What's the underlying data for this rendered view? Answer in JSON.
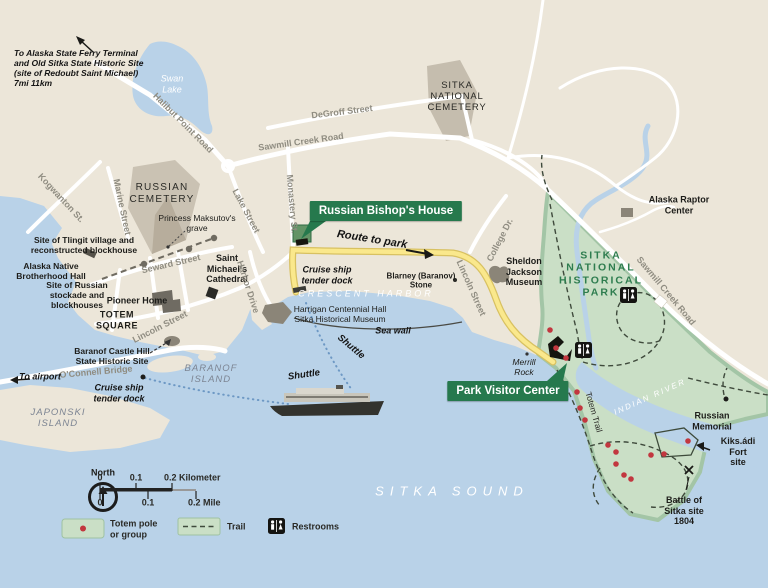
{
  "colors": {
    "water": "#b9d2e8",
    "land": "#ece6d9",
    "park": "#cadfc6",
    "park_border": "#a3c5a6",
    "road": "#ffffff",
    "road_label": "#8f8c81",
    "route_yellow": "#fae88c",
    "route_casing": "#d8c161",
    "badge_green": "#26794d",
    "park_label_green": "#2e7d4f",
    "totem_red": "#c2373f",
    "shuttle_blue": "#6d98c4",
    "building_gray": "#8b8578",
    "cemetery_gray": "#c8c0b1"
  },
  "labels": {
    "ferry_note": "To Alaska State Ferry Terminal\nand Old Sitka State Historic Site\n(site of Redoubt Saint Michael)\n7mi 11km",
    "swan_lake": "Swan\nLake",
    "halibut_point_road": "Halibut Point Road",
    "degroff_street": "DeGroff Street",
    "sawmill_creek_road_top": "Sawmill Creek Road",
    "sawmill_creek_road_park": "Sawmill Creek Road",
    "russian_cemetery": "RUSSIAN\nCEMETERY",
    "sitka_national_cemetery": "SITKA\nNATIONAL\nCEMETERY",
    "kogwanton_st": "Kogwanton St.",
    "marine_street": "Marine Street",
    "lake_street": "Lake Street",
    "monastery_st": "Monastery St.",
    "princess_grave": "Princess Maksutov's\ngrave",
    "tlingit_site": "Site of Tlingit village and\nreconstructed blockhouse",
    "anb_hall": "Alaska Native\nBrotherhood Hall",
    "russian_stockade_site": "Site of Russian\nstockade and\nblockhouses",
    "seward_street": "Seward Street",
    "pioneer_home": "Pioneer Home",
    "totem_square": "TOTEM\nSQUARE",
    "saint_michaels": "Saint\nMichael's\nCathedral",
    "lincoln_street_w": "Lincoln Street",
    "lincoln_street_e": "Lincoln Street",
    "harbor_drive": "Harbor Drive",
    "bishops_house_badge": "Russian Bishop's House",
    "route_to_park": "Route to park",
    "cruise_tender_center": "Cruise ship\ntender dock",
    "blarney_stone": "Blarney (Baranov)\nStone",
    "crescent_harbor": "CRESCENT HARBOR",
    "harrigan": "Harrigan Centennial Hall\nSitka Historical Museum",
    "sea_wall": "Sea wall",
    "shuttle_a": "Shuttle",
    "shuttle_b": "Shuttle",
    "sheldon_jackson": "Sheldon\nJackson\nMuseum",
    "college_dr": "College Dr.",
    "alaska_raptor": "Alaska Raptor Center",
    "park_name": "SITKA\nNATIONAL\nHISTORICAL\nPARK",
    "totem_trail": "Totem Trail",
    "indian_river": "INDIAN RIVER",
    "russian_memorial": "Russian\nMemorial",
    "kiksadi_fort": "Kiks.ádi\nFort site",
    "battle_site": "Battle of\nSitka site\n1804",
    "baranof_island": "BARANOF\nISLAND",
    "japonski_island": "JAPONSKI\nISLAND",
    "oconnell_bridge": "O'Connell Bridge",
    "to_airport": "To airport",
    "castle_hill": "Baranof Castle Hill\nState Historic Site",
    "cruise_tender_left": "Cruise ship\ntender dock",
    "sitka_sound": "SITKA SOUND",
    "merrill_rock": "Merrill\nRock",
    "visitor_center_badge": "Park Visitor Center"
  },
  "legend": {
    "north": "North",
    "totem": "Totem pole\nor group",
    "trail": "Trail",
    "restrooms": "Restrooms"
  },
  "scalebar": {
    "km": [
      "0",
      "0.1",
      "0.2 Kilometer"
    ],
    "mi": [
      "0",
      "0.1",
      "0.2 Mile"
    ]
  }
}
